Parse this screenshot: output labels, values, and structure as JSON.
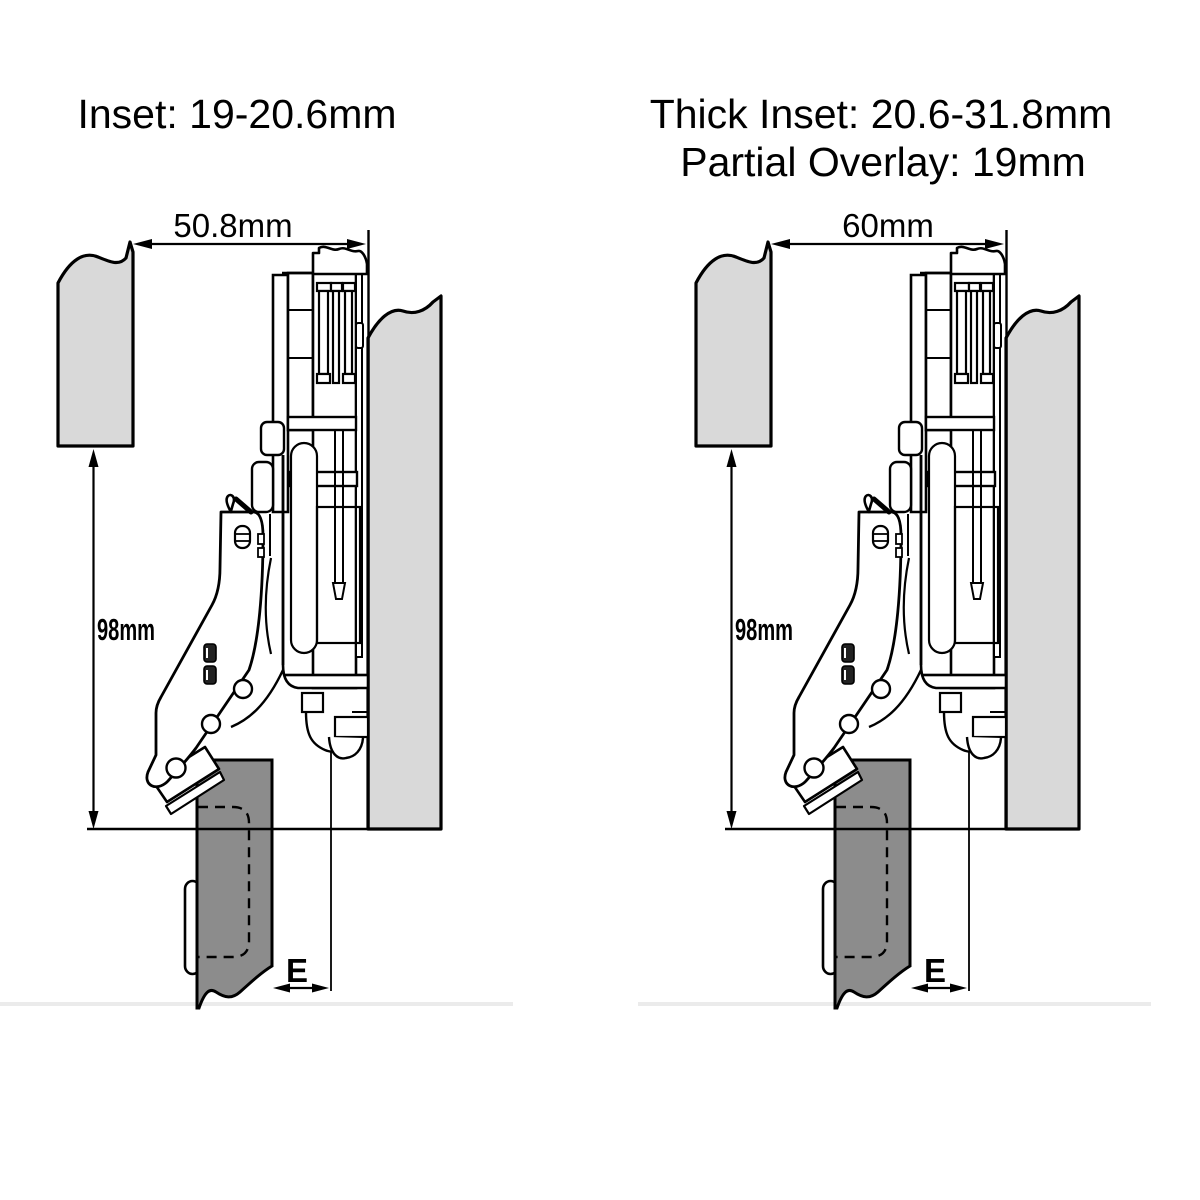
{
  "page": {
    "description": "Cabinet concealed hinge installation side-view diagrams, two variants",
    "background": "#ffffff"
  },
  "colors": {
    "panel_light": "#d9d9d9",
    "door_dark": "#8c8c8c",
    "line": "#000000",
    "separator": "#ebebeb",
    "white": "#ffffff"
  },
  "diagrams": {
    "left": {
      "title": "Inset: 19-20.6mm",
      "width_dimension": "50.8mm",
      "height_dimension": "98mm",
      "edge_dimension": "E"
    },
    "right": {
      "title_line1": "Thick Inset: 20.6-31.8mm",
      "title_line2": "Partial Overlay: 19mm",
      "width_dimension": "60mm",
      "height_dimension": "98mm",
      "edge_dimension": "E"
    }
  }
}
